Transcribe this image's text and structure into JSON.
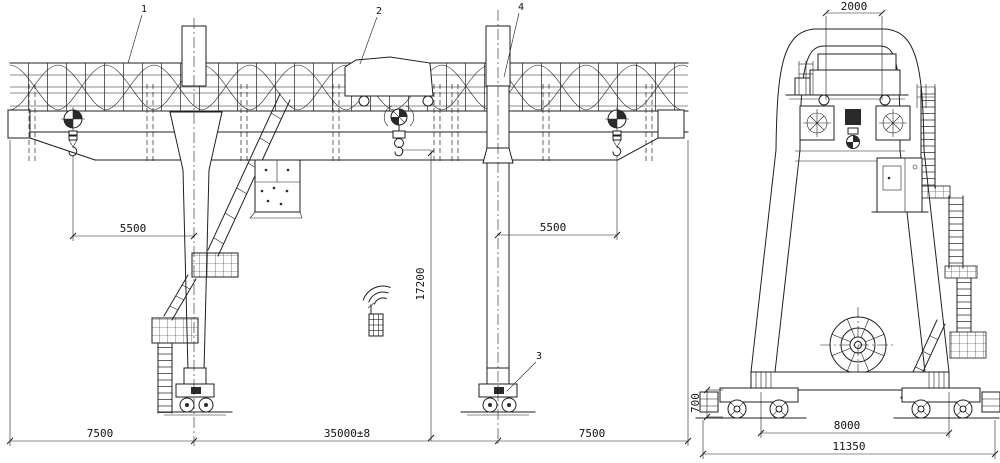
{
  "colors": {
    "line": "#1f1f1f",
    "background": "#ffffff"
  },
  "front_view": {
    "callouts": {
      "main_girder": "1",
      "trolley": "2",
      "travel_bogie": "3",
      "flexible_leg": "4"
    },
    "dims": {
      "left_hook_approach": "5500",
      "right_hook_approach": "5500",
      "lifting_height": "17200",
      "left_cantilever": "7500",
      "span": "35000±8",
      "right_cantilever": "7500"
    }
  },
  "side_view": {
    "dims": {
      "trolley_gauge": "2000",
      "rail_beam_height": "700",
      "bogie_wheelbase": "8000",
      "overall_width": "11350"
    }
  },
  "icons": {
    "remote_control": "remote-control-icon",
    "cable_reel": "cable-reel-icon",
    "main_hook": "hook-icon",
    "cantilever_tip_device": "hook-limit-icon"
  }
}
